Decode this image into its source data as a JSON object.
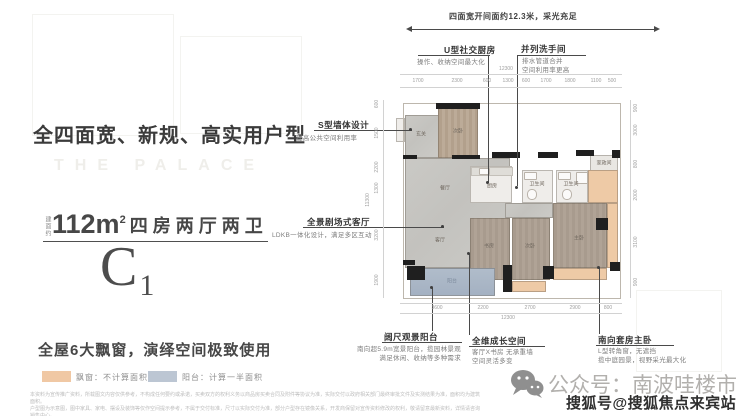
{
  "left_panel": {
    "headline": "全四面宽、新规、高实用户型",
    "brand_watermark": "THE PALACE",
    "area": {
      "prefix": "建面约",
      "value": "112m",
      "sup": "2",
      "rooms": "四房两厅两卫"
    },
    "unit": {
      "letter": "C",
      "number": "1"
    },
    "feature": "全屋6大飘窗，演绎空间极致使用",
    "legend": {
      "bay": {
        "label": "飘窗：不计算面积",
        "color": "#f0c8a4"
      },
      "balcony": {
        "label": "阳台：计算一半面积",
        "color": "#bcc6d3"
      }
    },
    "disclaimer": {
      "line1": "本资料为宣传推广资料，所载图文内容仅供参考，不构成任何要约或承诺，买卖双方的权利义务以商品房买卖合同及附件等协议为准，实际交付以政府相关部门最终审批文件及实测结果为准，面积均为建筑面积。",
      "line2": "户型图为示意图，图中家具、家电、摆设及装饰等仅作空间提示参考，不属于交付标准，尺寸以实际交付为准，部分户型存在镜像关系，开发商保留对宣传资料修改的权利，敬请留意最新资料，详情请咨询销售中心。"
    }
  },
  "plan": {
    "callouts": {
      "top_span": "四面宽开间面约12.3米，采光充足",
      "u_kitchen": {
        "title": "U型社交厨房",
        "sub": "操作、收纳空间最大化"
      },
      "twin_bath": {
        "title": "并列洗手间",
        "sub1": "排水管道合并",
        "sub2": "空间利用率更高"
      },
      "s_wall": {
        "title": "S型墙体设计",
        "sub": "提高公共空间利用率"
      },
      "theater": {
        "title": "全景剧场式客厅",
        "sub": "LDKB一体化设计，满足多区互动"
      },
      "balcony": {
        "title": "阔尺观景阳台",
        "sub1": "南向超5.9m宽景阳台，揽园林景观",
        "sub2": "满足休闲、收纳等多种需求"
      },
      "growth": {
        "title": "全维成长空间",
        "sub1": "客厅X书房 无承重墙",
        "sub2": "空间灵活多变"
      },
      "master": {
        "title": "南向套房主卧",
        "sub1": "L型转角窗，无遮挡",
        "sub2": "揽中庭园景，视野采光最大化"
      }
    },
    "rooms": {
      "entry": "玄关",
      "bed_tl": "次卧",
      "dining": "餐厅",
      "living": "客厅",
      "kitchen": "厨房",
      "bath1": "卫生间",
      "bath2": "卫生间",
      "utility": "家政间",
      "study": "书房",
      "bed2": "次卧",
      "master": "主卧",
      "balcony": "阳台"
    },
    "dims": {
      "top": [
        "1700",
        "2300",
        "600",
        "1300",
        "600",
        "1700",
        "1800",
        "1100",
        "500"
      ],
      "top_total": "12300",
      "bottom": [
        "3600",
        "2200",
        "2700",
        "2900",
        "800"
      ],
      "bottom_total": "12300",
      "left": [
        "600",
        "1500",
        "2200",
        "1300",
        "3200",
        "1900"
      ],
      "left_total": "11300",
      "right": [
        "900",
        "3000",
        "800",
        "2000",
        "3100",
        "900"
      ]
    }
  },
  "footer": {
    "wechat": "公众号：南波哇楼市",
    "sohu_watermark": "搜狐号@搜狐焦点来宾站"
  },
  "colors": {
    "bay_window": "#eecaa6",
    "balcony": "#aab7c7",
    "wood_floor": "#ab9e92",
    "living_gray": "#c7c6c2",
    "wall": "#1f1f1f"
  }
}
